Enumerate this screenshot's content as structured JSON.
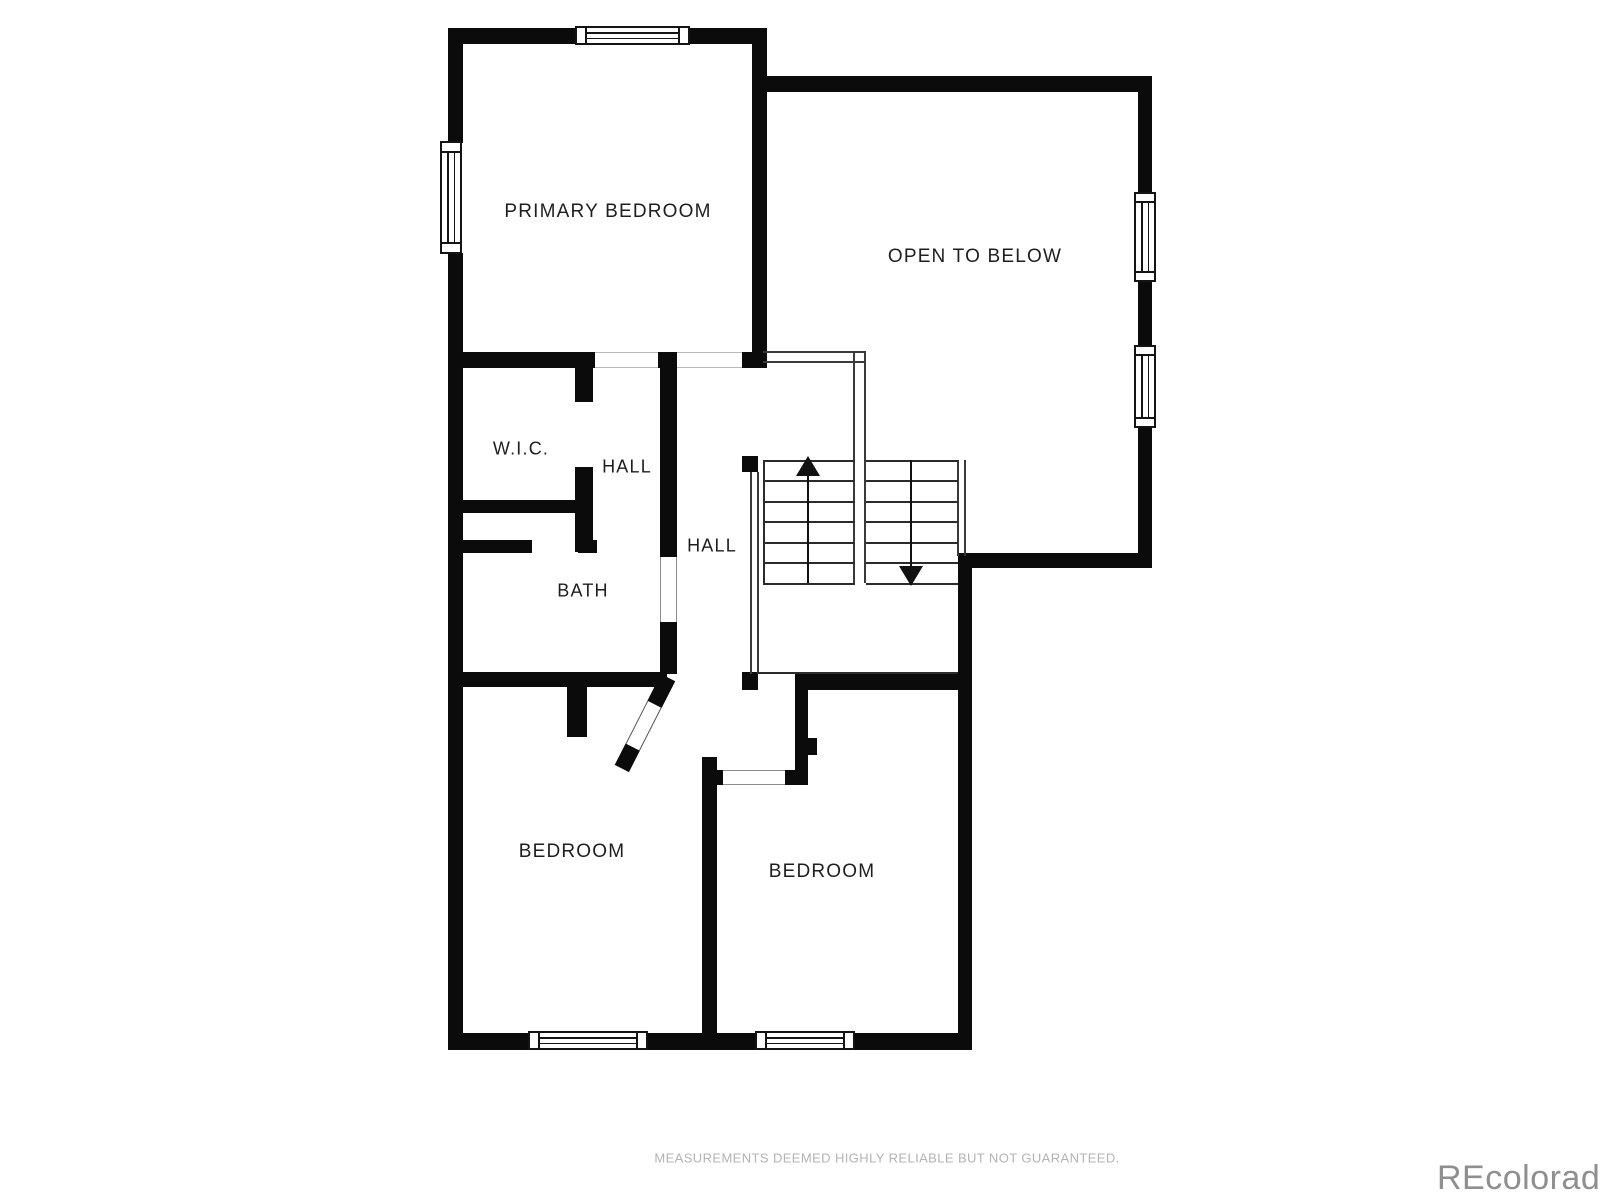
{
  "colors": {
    "wall": "#0b0b0b",
    "room_label": "#1e1e1e",
    "disclaimer": "#b3b3b3",
    "watermark": "#8f8f8f"
  },
  "rooms": [
    {
      "id": "primary-bedroom",
      "label": "PRIMARY BEDROOM"
    },
    {
      "id": "open-to-below",
      "label": "OPEN TO BELOW"
    },
    {
      "id": "wic",
      "label": "W.I.C."
    },
    {
      "id": "hall-upper",
      "label": "HALL"
    },
    {
      "id": "hall-lower",
      "label": "HALL"
    },
    {
      "id": "bath",
      "label": "BATH"
    },
    {
      "id": "bedroom-left",
      "label": "BEDROOM"
    },
    {
      "id": "bedroom-right",
      "label": "BEDROOM"
    }
  ],
  "stairs": {
    "up_direction": "up",
    "down_direction": "down",
    "treads": 6
  },
  "footer": {
    "disclaimer": "MEASUREMENTS DEEMED HIGHLY RELIABLE BUT NOT GUARANTEED."
  },
  "watermark": {
    "text": "REcolorado"
  }
}
